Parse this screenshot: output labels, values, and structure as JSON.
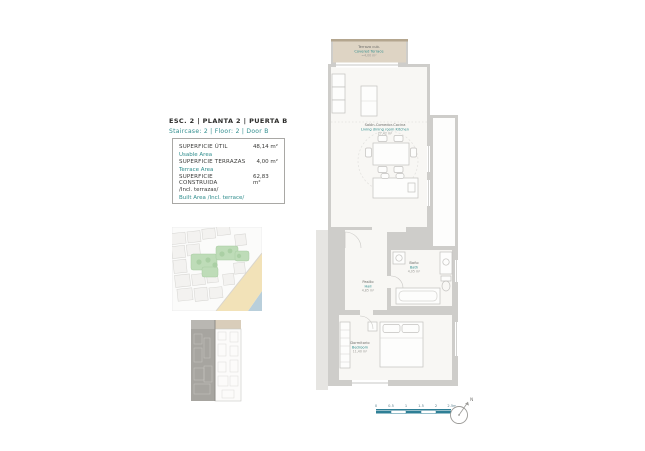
{
  "header": {
    "title_es": "ESC.  2 | PLANTA  2 | PUERTA B",
    "title_en": "Staircase: 2 | Floor: 2 | Door B"
  },
  "area_table": {
    "rows": [
      {
        "label_es": "SUPERFICIE ÚTIL",
        "label_en": "Usable Area",
        "value": "48,14 m²"
      },
      {
        "label_es": "SUPERFICIE TERRAZAS",
        "label_en": "Terrace Area",
        "value": "4,00 m²"
      },
      {
        "label_es": "SUPERFICIE CONSTRUIDA",
        "note_es": "/Incl. terrazas/",
        "label_en": "Built Area /Incl. terrace/",
        "value": "62,83 m²"
      }
    ]
  },
  "floor_plan": {
    "terrace": {
      "name_es": "Terraza cub.",
      "name_en": "Covered Terrace",
      "area": "=4,00 m²"
    },
    "living": {
      "name_es": "Salón-Comedor-Cocina",
      "name_en": "Living dining room Kitchen",
      "area": "27,42 m²"
    },
    "bath": {
      "name_es": "Baño",
      "name_en": "Bath",
      "area": "4,05 m²"
    },
    "hall": {
      "name_es": "Pasillo",
      "name_en": "Hall",
      "area": "4,85 m²"
    },
    "bedroom": {
      "name_es": "Dormitorio",
      "name_en": "Bedroom",
      "area": "11,40 m²"
    }
  },
  "scale_bar": {
    "tick_labels": [
      "0",
      "0.5",
      "1",
      "1.5",
      "2",
      "2.5m"
    ]
  },
  "compass": {
    "label": "N"
  },
  "colors": {
    "teal": "#2f8d8d",
    "wall_gray": "#cecdca",
    "room_fill": "#f8f7f4",
    "terrace_fill": "#ded4c4",
    "map_green": "#bedcb8",
    "map_sand": "#f2e2b8",
    "map_sea": "#b9cfdb",
    "scale_blue": "#2e7f96"
  }
}
